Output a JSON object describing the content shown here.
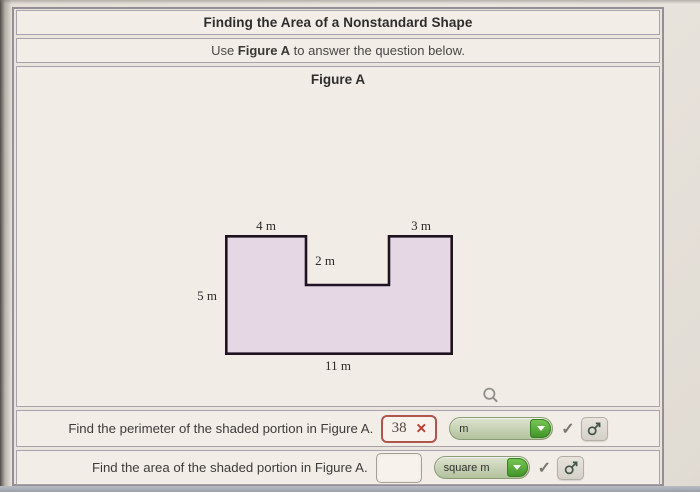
{
  "header": {
    "title": "Finding the Area of a Nonstandard Shape"
  },
  "instruction": {
    "prefix": "Use ",
    "figure_ref": "Figure A",
    "suffix": " to answer the question below."
  },
  "figure": {
    "title": "Figure A",
    "shape": {
      "type": "rectilinear-polygon-with-top-notch",
      "fill": "#e5d7e3",
      "outline": "#1f1322",
      "labels": {
        "top_left": "4 m",
        "top_right": "3 m",
        "notch_depth": "2 m",
        "left_side": "5 m",
        "bottom": "11 m"
      },
      "dimensions_m": {
        "top_left": 4,
        "top_right": 3,
        "notch_depth": 2,
        "left_side": 5,
        "bottom": 11
      }
    }
  },
  "questions": {
    "perimeter": {
      "prompt": "Find the perimeter of the shaded portion in Figure A.",
      "answer_value": "38",
      "answer_state": "incorrect",
      "incorrect_mark": "✕",
      "unit_selected": "m"
    },
    "area": {
      "prompt": "Find the area of the shaded portion in Figure A.",
      "answer_value": "",
      "answer_state": "unanswered",
      "unit_selected": "square m"
    }
  },
  "icons": {
    "check": "✓"
  },
  "colors": {
    "accent_green": "#4aa132",
    "dropdown_bg": "#c3d1ae",
    "error_red": "#c23a2e",
    "shape_fill": "#e5d7e3",
    "shape_outline": "#1f1322",
    "panel_bg": "#f2ede6",
    "page_bg": "#e9e4dd"
  }
}
